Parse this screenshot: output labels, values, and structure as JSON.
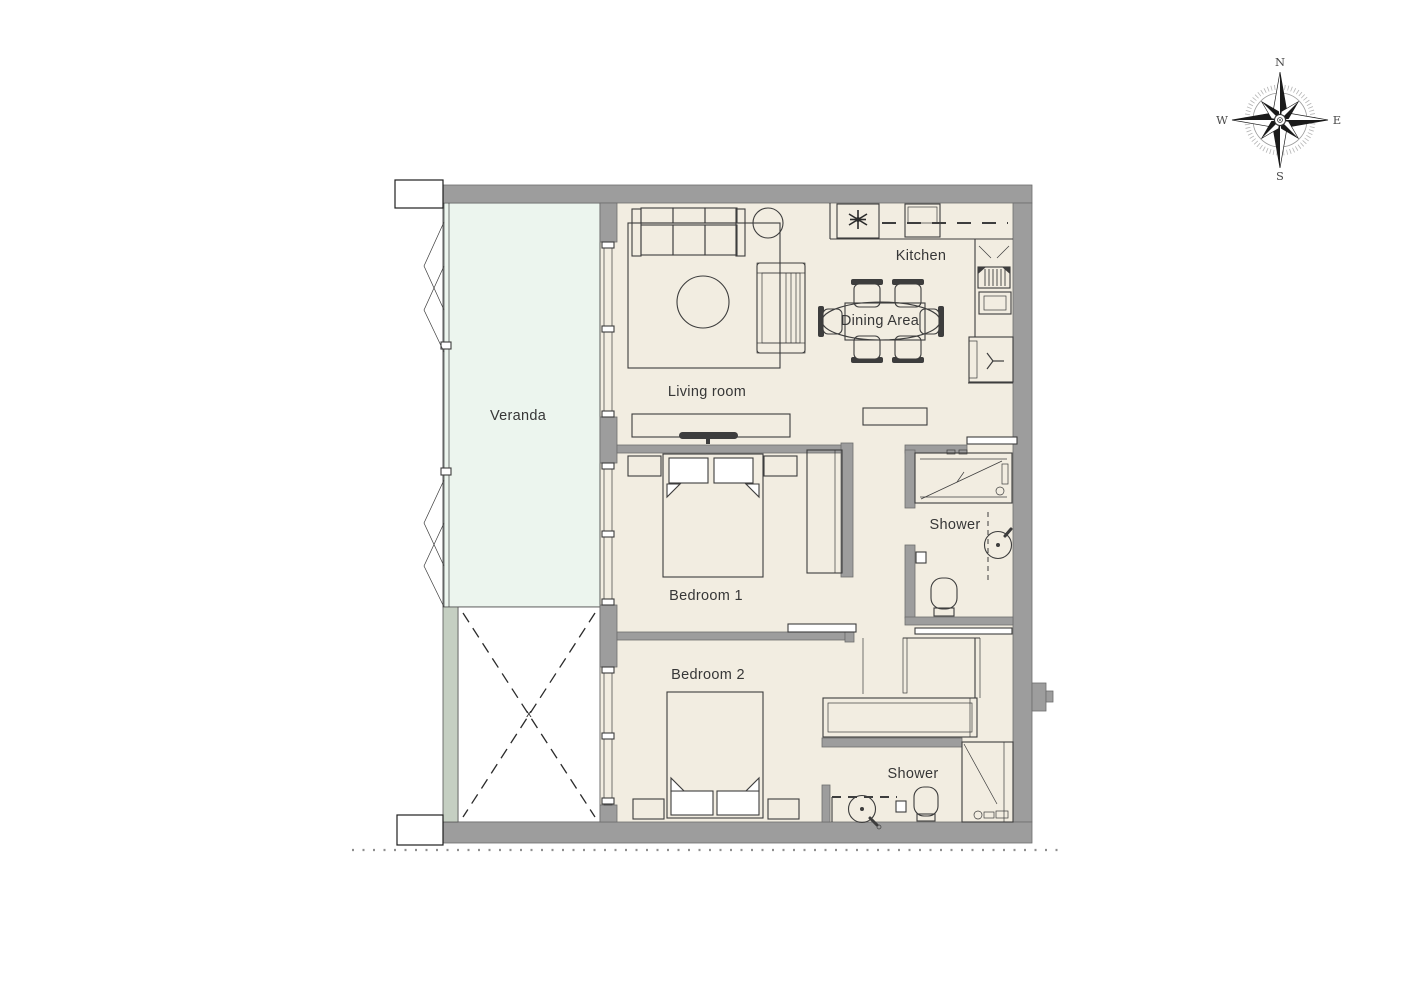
{
  "plan": {
    "rooms": {
      "veranda": "Veranda",
      "living_room": "Living room",
      "kitchen": "Kitchen",
      "dining_area": "Dining Area",
      "bedroom_1": "Bedroom 1",
      "bedroom_2": "Bedroom 2",
      "shower_1": "Shower",
      "shower_2": "Shower"
    },
    "void_marker": "x"
  },
  "compass": {
    "north": "N",
    "east": "E",
    "south": "S",
    "west": "W"
  },
  "colors": {
    "background": "#ffffff",
    "floor": "#f2ede1",
    "veranda_floor": "#ecf5ee",
    "wall": "#9d9d9d",
    "column": "#c5cfc2",
    "line": "#3d3d3d"
  }
}
